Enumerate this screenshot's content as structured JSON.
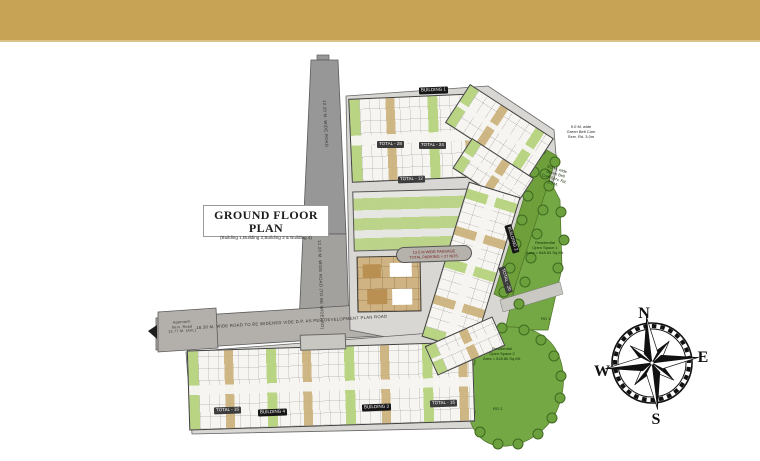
{
  "banner": {
    "color": "#c7a355"
  },
  "title_block": {
    "title": "GROUND FLOOR PLAN",
    "subtitle": "(Building 1,Building 2,Building 3 & Building 4)"
  },
  "compass": {
    "north": "N",
    "south": "S",
    "east": "E",
    "west": "W"
  },
  "roads": {
    "top_road_label": "12.20 M. WIDE ROAD",
    "mid_road_label": "12.20 M. WIDE ROAD (TO BE WIDENED)",
    "main_road_label": "18.30 M. WIDE ROAD TO BE WIDENED VIDE D.P. AS PER DEVELOPMENT PLAN ROAD",
    "approach_lines": [
      "Approach",
      "Serv. Road",
      "13.77 M. (AVL)"
    ]
  },
  "parking_band": {
    "line1": "13.5 M WIDE PASSAGE",
    "line2": "TOTAL PARKING = 27 NOS."
  },
  "chips": [
    {
      "label": "BUILDING 1"
    },
    {
      "label": "TOTAL - 28"
    },
    {
      "label": "TOTAL - 24"
    },
    {
      "label": "BUILDING 2"
    },
    {
      "label": "TOTAL - 20"
    },
    {
      "label": "TOTAL - 16"
    },
    {
      "label": "BUILDING 4"
    },
    {
      "label": "BUILDING 3"
    },
    {
      "label": "TOTAL - 16"
    },
    {
      "label": "TOTAL - 12"
    }
  ],
  "green": {
    "belt_note": [
      "9.0 M. wide",
      "Green Belt Cum",
      "Serv. Rd. 3.0m"
    ],
    "belt_note2": [
      "9.0 M. wide",
      "Green Belt",
      "Cum Serv. Rd.",
      "3.0 M."
    ],
    "open_space_1": [
      "Residential",
      "Open Space 1",
      "Area = 648.63 Sq.Mt."
    ],
    "open_space_2": [
      "Residential",
      "Open Space 2",
      "Area = 518.80 Sq.Mt."
    ],
    "rg1": "RG 1",
    "rg2": "RG 2"
  }
}
